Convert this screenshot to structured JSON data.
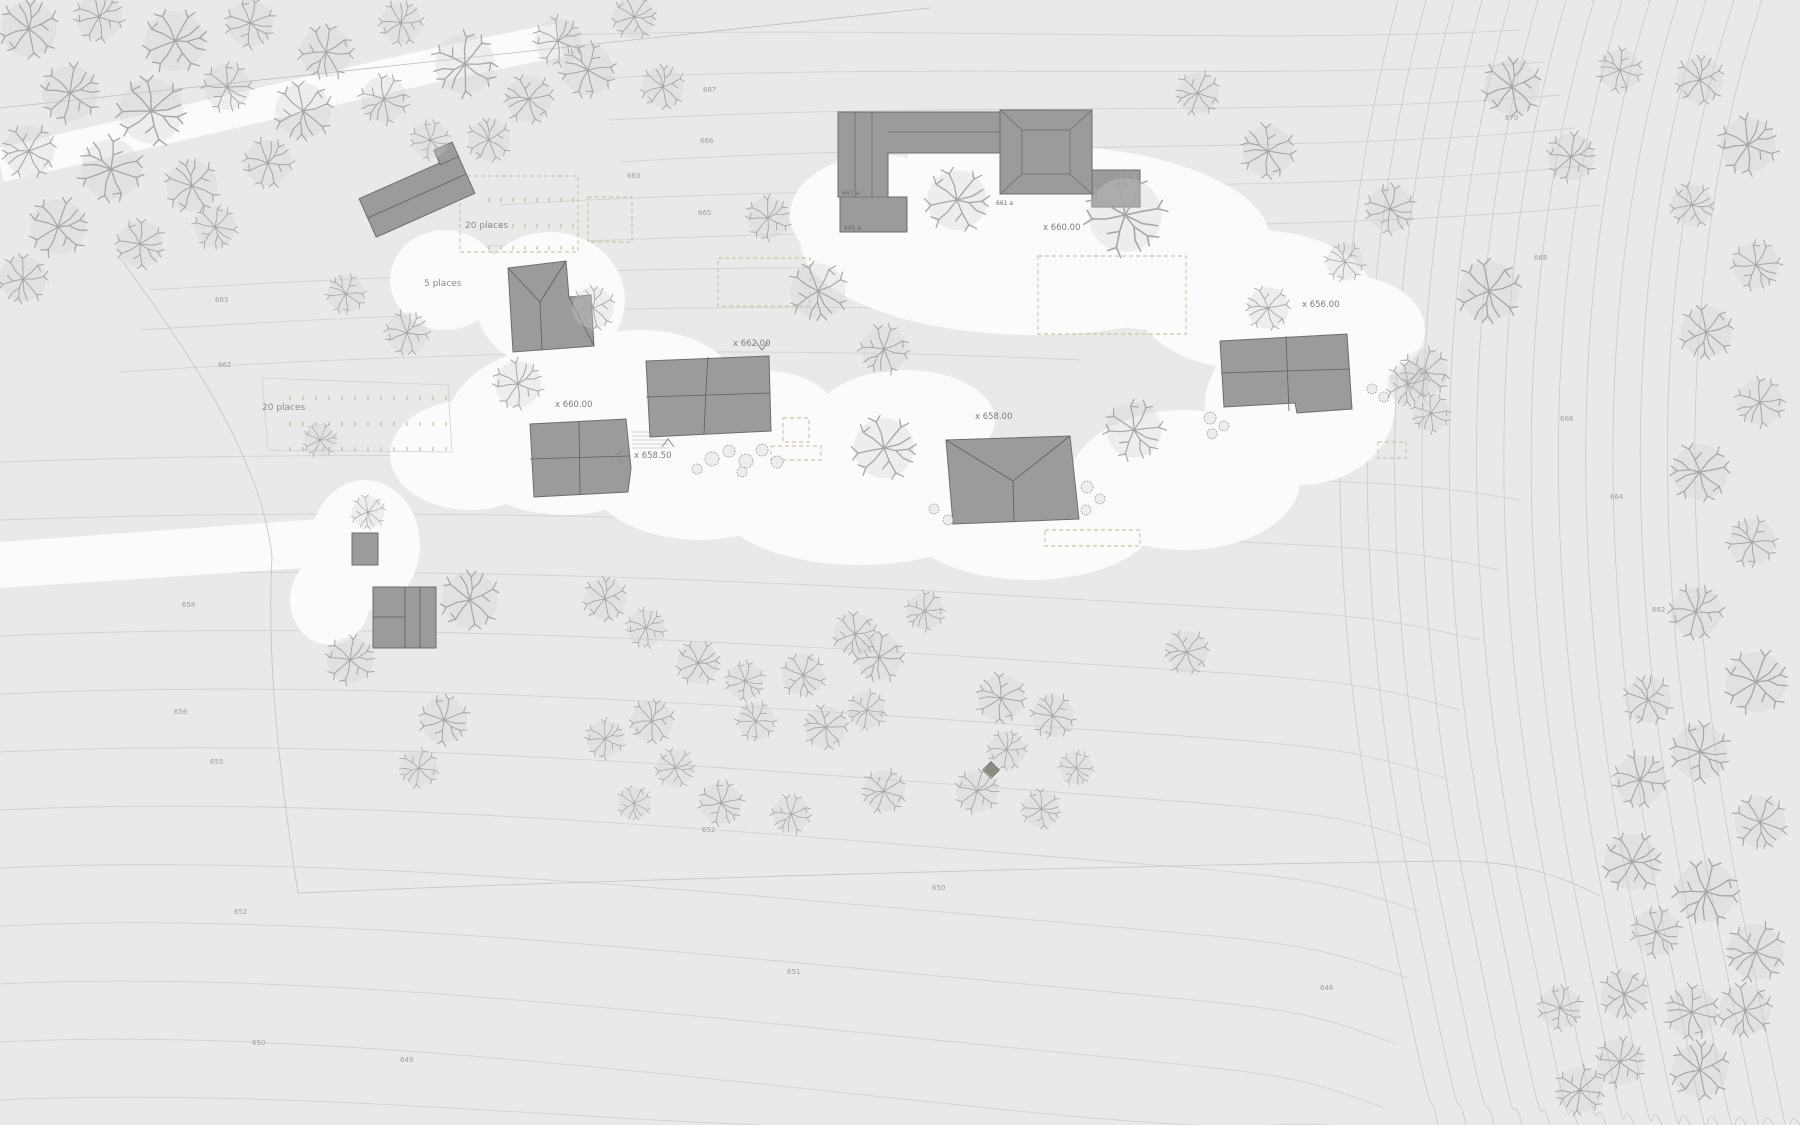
{
  "map": {
    "spot_labels": [
      {
        "text": "x 660.00"
      },
      {
        "text": "x 662.00"
      },
      {
        "text": "x 660.00"
      },
      {
        "text": "x 658.50"
      },
      {
        "text": "x 658.00"
      },
      {
        "text": "x 656.00"
      }
    ],
    "parking_labels": [
      {
        "text": "20 places"
      },
      {
        "text": "20 places"
      },
      {
        "text": "5 places"
      }
    ],
    "building_labels": [
      {
        "text": "667 a"
      },
      {
        "text": "665 a"
      },
      {
        "text": "661 a"
      }
    ],
    "contour_labels": [
      {
        "text": "667"
      },
      {
        "text": "666"
      },
      {
        "text": "665"
      },
      {
        "text": "663"
      },
      {
        "text": "670"
      },
      {
        "text": "668"
      },
      {
        "text": "666"
      },
      {
        "text": "664"
      },
      {
        "text": "662"
      },
      {
        "text": "663"
      },
      {
        "text": "662"
      },
      {
        "text": "658"
      },
      {
        "text": "656"
      },
      {
        "text": "655"
      },
      {
        "text": "652"
      },
      {
        "text": "650"
      },
      {
        "text": "649"
      },
      {
        "text": "651"
      },
      {
        "text": "650"
      },
      {
        "text": "646"
      },
      {
        "text": "652"
      }
    ],
    "colors": {
      "background": "#e9e9e9",
      "paths_white": "#fbfbfb",
      "building_gray": "#9b9b9b",
      "contour_gray": "#d2d2d2",
      "parking_dash_olive": "#c4ba8e"
    }
  }
}
